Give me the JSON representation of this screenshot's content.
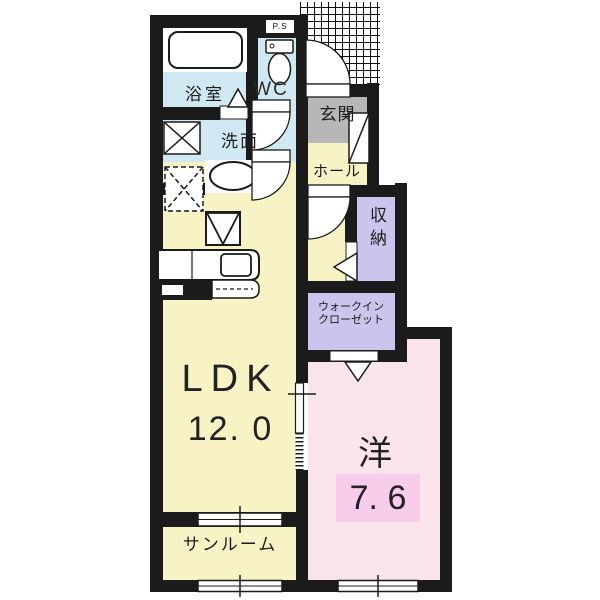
{
  "floorplan": {
    "rooms": {
      "bath": {
        "label": "浴室"
      },
      "wc": {
        "label": "WC"
      },
      "pipe_space": {
        "label": "P.S"
      },
      "entrance": {
        "label": "玄関"
      },
      "hall": {
        "label": "ホール"
      },
      "washroom": {
        "label": "洗面"
      },
      "storage": {
        "label": "収納"
      },
      "walk_in_closet": {
        "label_line1": "ウォークイン",
        "label_line2": "クローゼット"
      },
      "ldk": {
        "label": "LDK",
        "size": "12. 0"
      },
      "western_room": {
        "label": "洋",
        "size": "7. 6"
      },
      "sunroom": {
        "label": "サンルーム"
      }
    },
    "colors": {
      "wall": "#1b1b1b",
      "wet_area": "#cfe8f2",
      "living": "#f8f3c5",
      "entrance_floor": "#b7b7b7",
      "closet": "#c9c5ec",
      "bedroom": "#f9e4ec",
      "size_highlight": "#f8cdec"
    }
  }
}
